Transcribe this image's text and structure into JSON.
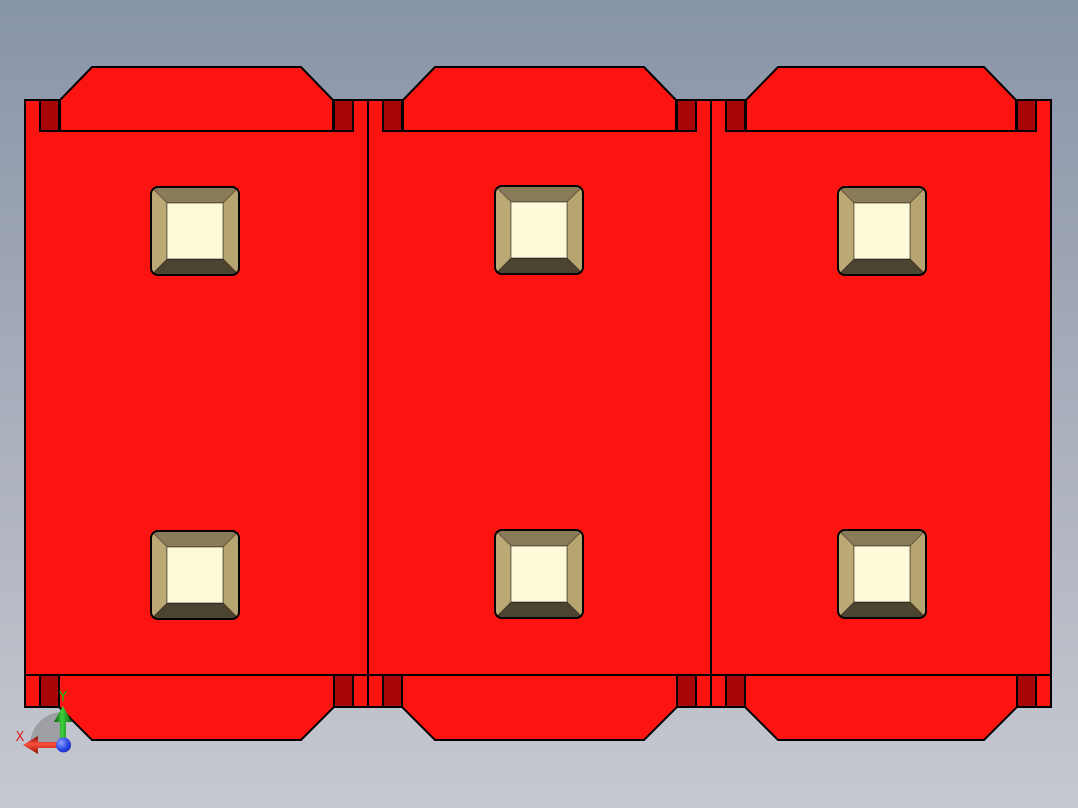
{
  "viewport": {
    "width": 1078,
    "height": 808,
    "background_top": "#8894a8",
    "background_mid": "#a8aebb",
    "background_bottom": "#c6c9d0"
  },
  "model": {
    "description": "Red CAD part: three identical panels with chamfered top and bottom flaps, dark red corner tabs, and two square counterbored holes per panel",
    "colors": {
      "face": "#fb1410",
      "tab": "#a80508",
      "outline": "#000000",
      "hole_bevel_top": "#8a7c58",
      "hole_bevel_left": "#bcaa76",
      "hole_bevel_right": "#b6a571",
      "hole_bevel_bottom": "#4b4431",
      "hole_center": "#fdf9d9"
    },
    "body": {
      "top": 100,
      "bottom": 707
    },
    "face_bottom_edge": 675,
    "top_flap": {
      "y_outer": 67,
      "y_shoulder": 100,
      "y_base": 131,
      "inset_base": 35,
      "inset_outer": 67
    },
    "bottom_flap": {
      "y_outer": 740,
      "y_shoulder": 707,
      "y_base": 675,
      "inset_base": 34,
      "inset_outer": 67
    },
    "tab": {
      "inset": 15,
      "width": 19,
      "height_top": 31,
      "height_bottom": 32
    },
    "panels": [
      {
        "label": "panel-1",
        "left": 25,
        "right": 368
      },
      {
        "label": "panel-2",
        "left": 368,
        "right": 711
      },
      {
        "label": "panel-3",
        "left": 711,
        "right": 1051
      }
    ],
    "hole_shape": {
      "width": 90,
      "height": 90,
      "bevel": 17,
      "corner_radius": 8
    },
    "holes": [
      {
        "x": 150,
        "y": 186
      },
      {
        "x": 150,
        "y": 530
      },
      {
        "x": 494,
        "y": 185
      },
      {
        "x": 494,
        "y": 529
      },
      {
        "x": 837,
        "y": 186
      },
      {
        "x": 837,
        "y": 529
      }
    ]
  },
  "axis_triad": {
    "origin": {
      "x": 63,
      "y": 745
    },
    "sector_radius": 33,
    "labels": {
      "x": "X",
      "y": "Y"
    },
    "colors": {
      "x_axis": "#e02020",
      "y_axis": "#12c512",
      "z_ball": "#2742e6",
      "sector": "#9b9da2"
    }
  }
}
